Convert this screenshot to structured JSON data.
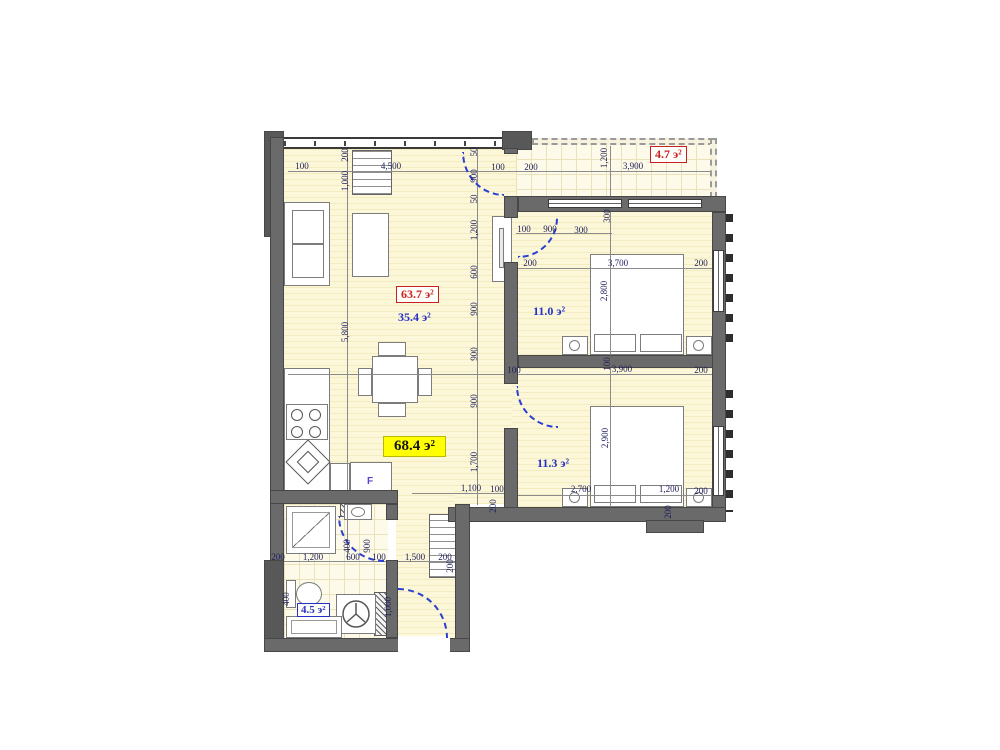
{
  "title": "Apartment floor plan",
  "rooms": {
    "living_total": {
      "label": "63.7 э²"
    },
    "living": {
      "label": "35.4 э²"
    },
    "overall": {
      "label": "68.4 э²"
    },
    "balcony": {
      "label": "4.7 э²"
    },
    "bedroom1": {
      "label": "11.0 э²"
    },
    "bedroom2": {
      "label": "11.3 э²"
    },
    "bathroom": {
      "label": "4.5 э²"
    },
    "fridge_label": "F"
  },
  "palette": {
    "wall": "#6a6a6a",
    "floor_cream": "#fbf7d8",
    "tile_line": "#eae2ba",
    "dim_text": "#21215c",
    "label_blue": "#2431c6",
    "label_red": "#c82020",
    "highlight_yellow": "#ffff00",
    "door_arc_blue": "#2b3fd0"
  },
  "dimensions": [
    {
      "t": "100",
      "x": 302,
      "y": 166
    },
    {
      "t": "4,500",
      "x": 391,
      "y": 166
    },
    {
      "t": "100",
      "x": 498,
      "y": 167
    },
    {
      "t": "200",
      "x": 531,
      "y": 167
    },
    {
      "t": "1,200",
      "x": 604,
      "y": 158,
      "r": 1
    },
    {
      "t": "3,900",
      "x": 633,
      "y": 166
    },
    {
      "t": "200",
      "x": 345,
      "y": 155,
      "r": 1
    },
    {
      "t": "1,000",
      "x": 345,
      "y": 181,
      "r": 1
    },
    {
      "t": "5,800",
      "x": 345,
      "y": 332,
      "r": 1
    },
    {
      "t": "50",
      "x": 474,
      "y": 152,
      "r": 1
    },
    {
      "t": "900",
      "x": 474,
      "y": 176,
      "r": 1
    },
    {
      "t": "50",
      "x": 474,
      "y": 199,
      "r": 1
    },
    {
      "t": "1,200",
      "x": 474,
      "y": 230,
      "r": 1
    },
    {
      "t": "600",
      "x": 474,
      "y": 272,
      "r": 1
    },
    {
      "t": "900",
      "x": 474,
      "y": 309,
      "r": 1
    },
    {
      "t": "900",
      "x": 474,
      "y": 354,
      "r": 1
    },
    {
      "t": "900",
      "x": 474,
      "y": 401,
      "r": 1
    },
    {
      "t": "1,700",
      "x": 474,
      "y": 462,
      "r": 1
    },
    {
      "t": "100",
      "x": 524,
      "y": 229
    },
    {
      "t": "900",
      "x": 550,
      "y": 229
    },
    {
      "t": "300",
      "x": 581,
      "y": 230
    },
    {
      "t": "300",
      "x": 607,
      "y": 216,
      "r": 1
    },
    {
      "t": "200",
      "x": 530,
      "y": 263
    },
    {
      "t": "3,700",
      "x": 618,
      "y": 263
    },
    {
      "t": "200",
      "x": 701,
      "y": 263
    },
    {
      "t": "2,800",
      "x": 604,
      "y": 291,
      "r": 1
    },
    {
      "t": "100",
      "x": 607,
      "y": 364,
      "r": 1
    },
    {
      "t": "100",
      "x": 514,
      "y": 370
    },
    {
      "t": "3,900",
      "x": 622,
      "y": 369
    },
    {
      "t": "200",
      "x": 701,
      "y": 370
    },
    {
      "t": "2,900",
      "x": 605,
      "y": 438,
      "r": 1
    },
    {
      "t": "2,700",
      "x": 581,
      "y": 489
    },
    {
      "t": "1,200",
      "x": 669,
      "y": 489
    },
    {
      "t": "200",
      "x": 701,
      "y": 491
    },
    {
      "t": "200",
      "x": 668,
      "y": 512,
      "r": 1
    },
    {
      "t": "1,100",
      "x": 471,
      "y": 488
    },
    {
      "t": "100",
      "x": 497,
      "y": 489
    },
    {
      "t": "200",
      "x": 493,
      "y": 506,
      "r": 1
    },
    {
      "t": "400",
      "x": 347,
      "y": 546,
      "r": 1
    },
    {
      "t": "900",
      "x": 367,
      "y": 546,
      "r": 1
    },
    {
      "t": "200",
      "x": 278,
      "y": 557
    },
    {
      "t": "1,200",
      "x": 313,
      "y": 557
    },
    {
      "t": "600",
      "x": 353,
      "y": 557
    },
    {
      "t": "100",
      "x": 379,
      "y": 557
    },
    {
      "t": "1,500",
      "x": 415,
      "y": 557
    },
    {
      "t": "200",
      "x": 445,
      "y": 557
    },
    {
      "t": "200",
      "x": 450,
      "y": 566,
      "r": 1
    },
    {
      "t": "1,000",
      "x": 388,
      "y": 607,
      "r": 1
    },
    {
      "t": "400",
      "x": 286,
      "y": 599,
      "r": 1
    }
  ]
}
